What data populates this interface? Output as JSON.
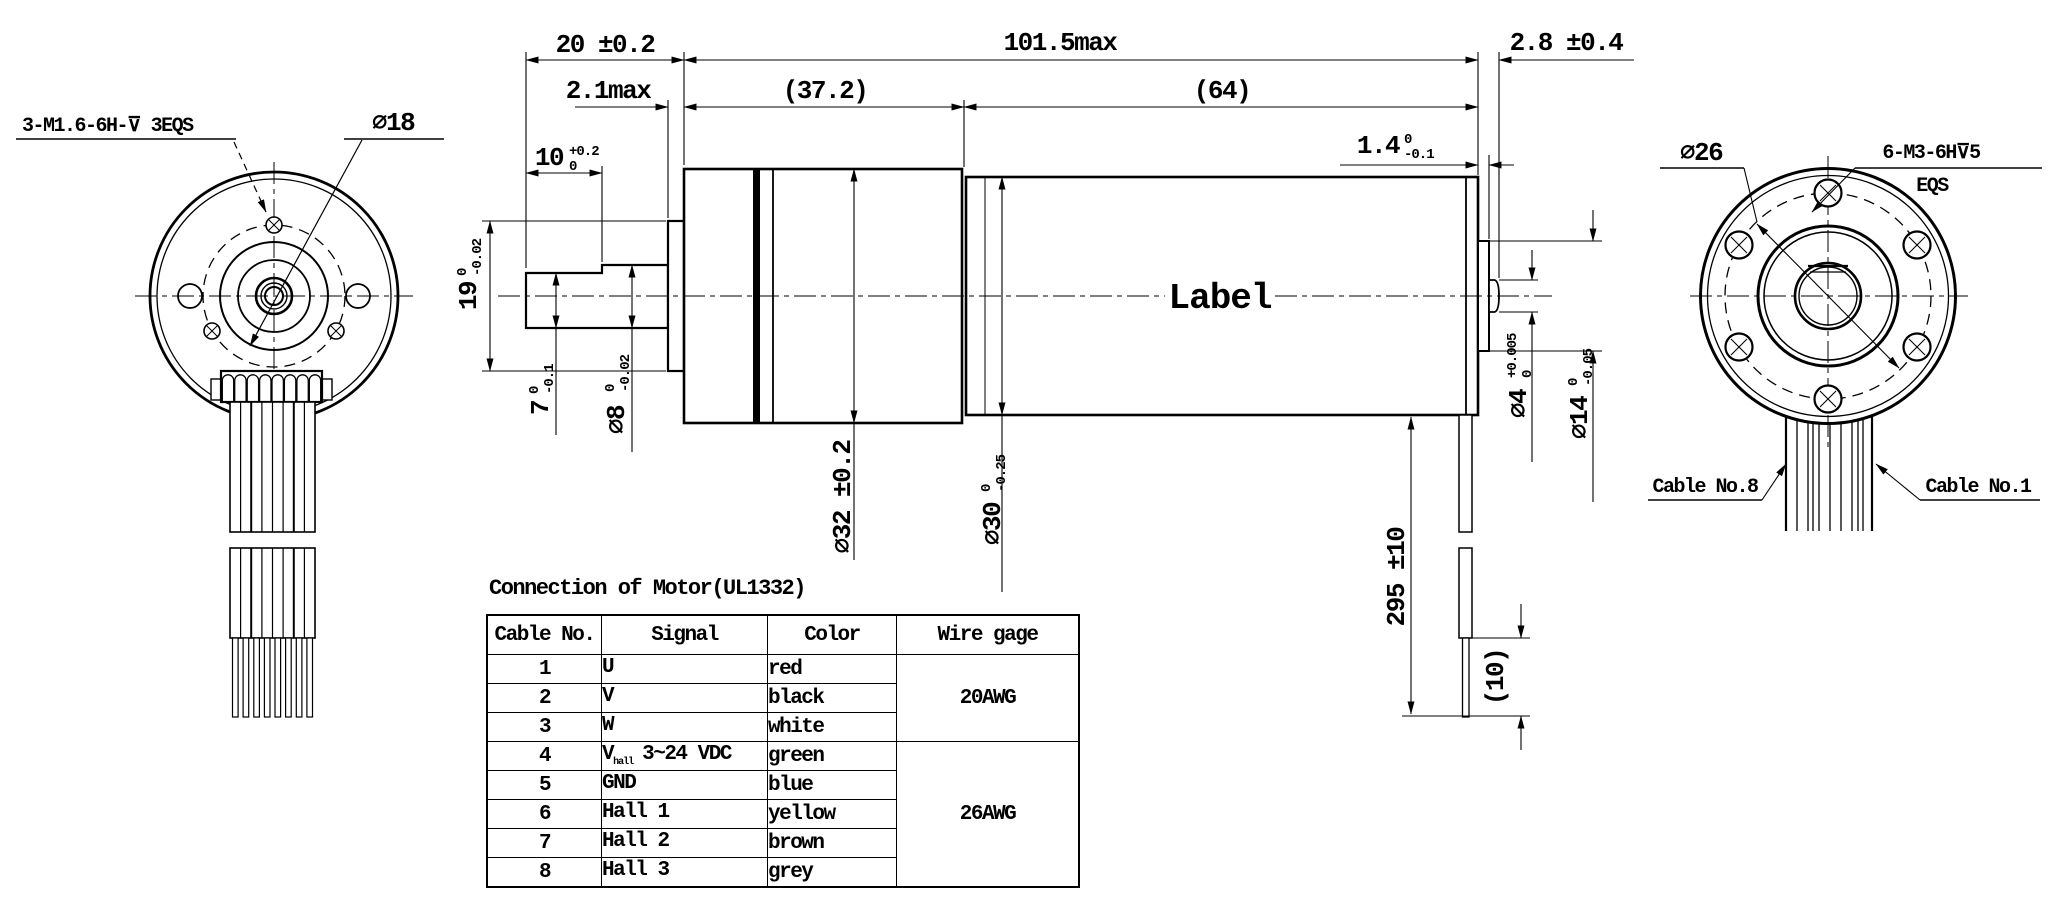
{
  "colors": {
    "ink": "#000000",
    "paper": "#ffffff"
  },
  "left_view": {
    "thread_note": "3-M1.6-6H-⊽ 3EQS",
    "bolt_circle_dia": "∅18"
  },
  "side_view": {
    "label_text": "Label",
    "dims": {
      "front_len": "20 ±0.2",
      "body_len": "101.5max",
      "rear_pin_len": "2.8 ±0.4",
      "plate_thk": "2.1max",
      "gearbox_len": "(37.2)",
      "motor_len": "(64)",
      "shaft_flat_len": {
        "v": "10",
        "top": "+0.2",
        "bot": "0"
      },
      "pilot_dia": {
        "v": "19",
        "top": "0",
        "bot": "-0.02"
      },
      "flat_height": {
        "v": "7",
        "top": "0",
        "bot": "-0.1"
      },
      "shaft_dia": {
        "v": "∅8",
        "top": "0",
        "bot": "-0.02"
      },
      "boss_thk": {
        "v": "1.4",
        "top": "0",
        "bot": "-0.1"
      },
      "gearbox_dia": "∅32 ±0.2",
      "motor_dia": {
        "v": "∅30",
        "top": "0",
        "bot": "-0.25"
      },
      "pin_dia": {
        "v": "∅4",
        "top": "+0.005",
        "bot": "0"
      },
      "boss_dia": {
        "v": "∅14",
        "top": "0",
        "bot": "-0.05"
      },
      "cable_len": "295 ±10",
      "strip_len": "(10)"
    }
  },
  "right_view": {
    "bolt_circle_dia": "∅26",
    "thread_note_line1": "6-M3-6H⊽5",
    "thread_note_line2": "EQS",
    "cable_no8": "Cable No.8",
    "cable_no1": "Cable No.1"
  },
  "table": {
    "title": "Connection of Motor(UL1332)",
    "headers": [
      "Cable No.",
      "Signal",
      "Color",
      "Wire gage"
    ],
    "rows": [
      {
        "no": "1",
        "signal": "U",
        "sub": "",
        "rest": "",
        "color": "red"
      },
      {
        "no": "2",
        "signal": "V",
        "sub": "",
        "rest": "",
        "color": "black"
      },
      {
        "no": "3",
        "signal": "W",
        "sub": "",
        "rest": "",
        "color": "white"
      },
      {
        "no": "4",
        "signal": "V",
        "sub": "hall",
        "rest": "3~24 VDC",
        "color": "green"
      },
      {
        "no": "5",
        "signal": "GND",
        "sub": "",
        "rest": "",
        "color": "blue"
      },
      {
        "no": "6",
        "signal": "Hall 1",
        "sub": "",
        "rest": "",
        "color": "yellow"
      },
      {
        "no": "7",
        "signal": "Hall 2",
        "sub": "",
        "rest": "",
        "color": "brown"
      },
      {
        "no": "8",
        "signal": "Hall 3",
        "sub": "",
        "rest": "",
        "color": "grey"
      }
    ],
    "wire_gage_rows_1_3": "20AWG",
    "wire_gage_rows_4_8": "26AWG"
  }
}
